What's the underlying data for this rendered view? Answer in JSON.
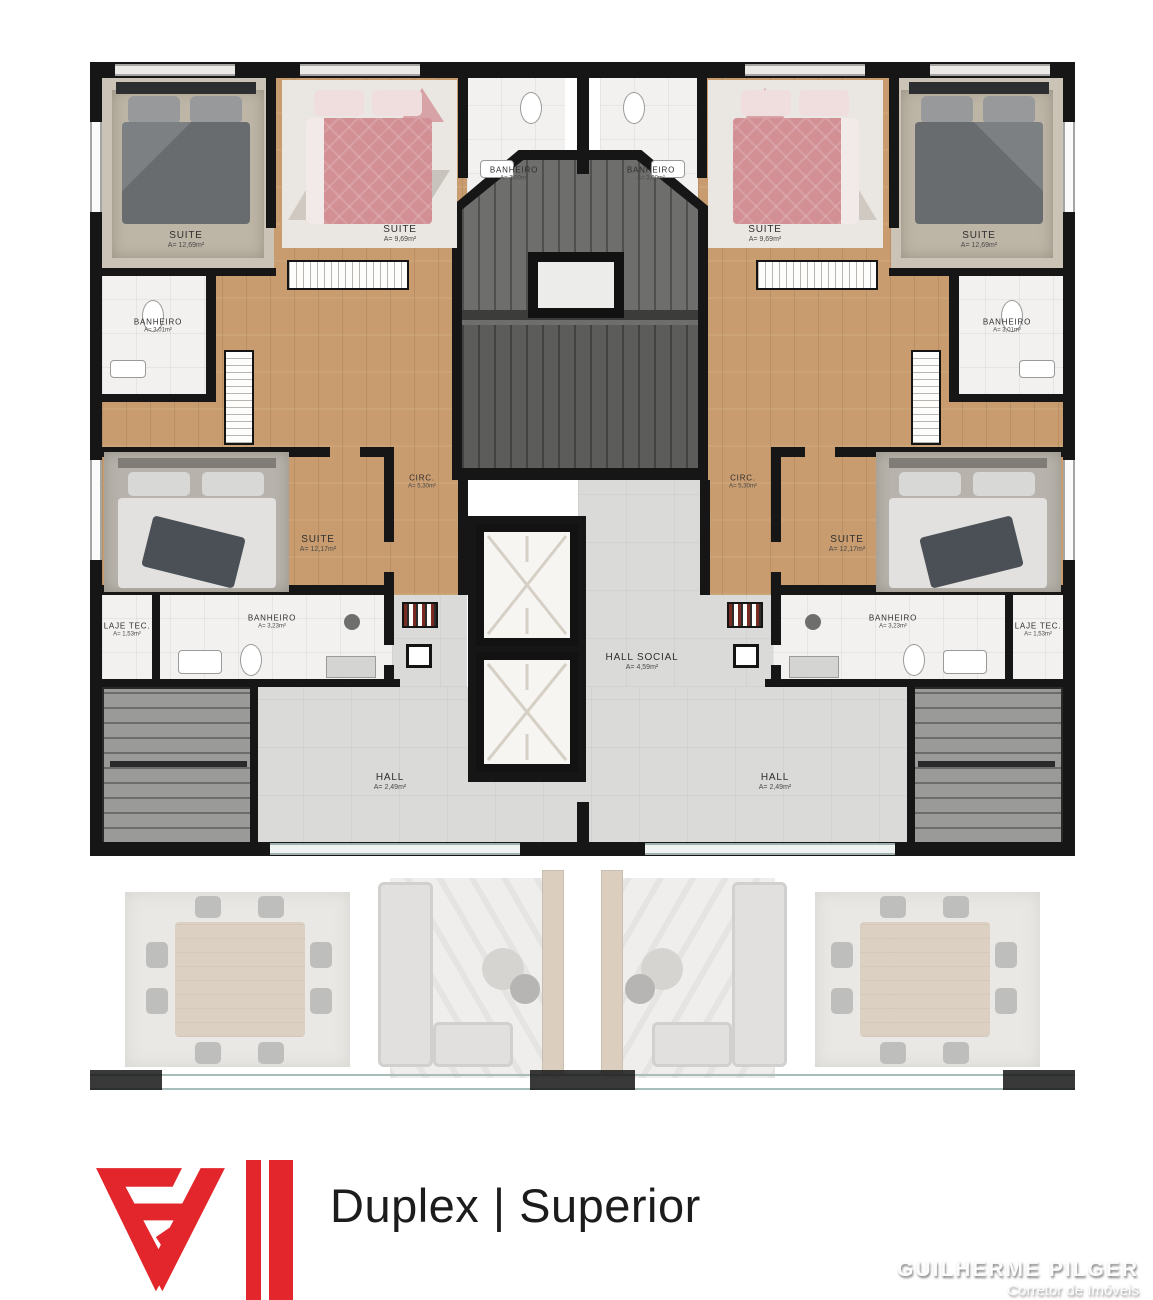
{
  "rooms": {
    "suite_corner": {
      "name": "SUITE",
      "area": "A= 12,69m²"
    },
    "suite_top": {
      "name": "SUITE",
      "area": "A= 9,69m²"
    },
    "banheiro_top": {
      "name": "BANHEIRO",
      "area": "A= 3,00m²"
    },
    "banheiro_side": {
      "name": "BANHEIRO",
      "area": "A= 3,01m²"
    },
    "suite_master": {
      "name": "SUITE",
      "area": "A= 12,17m²"
    },
    "circ": {
      "name": "CIRC.",
      "area": "A= 5,30m²"
    },
    "banheiro_lower": {
      "name": "BANHEIRO",
      "area": "A= 3,23m²"
    },
    "laje_tec": {
      "name": "LAJE TEC.",
      "area": "A= 1,53m²"
    },
    "hall": {
      "name": "HALL",
      "area": "A= 2,49m²"
    },
    "hall_social": {
      "name": "HALL SOCIAL",
      "area": "A= 4,59m²"
    }
  },
  "footer": {
    "title": "Duplex | Superior",
    "agent_name": "GUILHERME PILGER",
    "agent_role": "Corretor de Imóveis"
  },
  "colors": {
    "accent_red": "#e2262c",
    "wall_black": "#161616",
    "wood_floor": "#c99c6f",
    "tile_white": "#f2f1ef",
    "hall_gray": "#dadad8",
    "stair_gray": "#6e6e6c"
  }
}
